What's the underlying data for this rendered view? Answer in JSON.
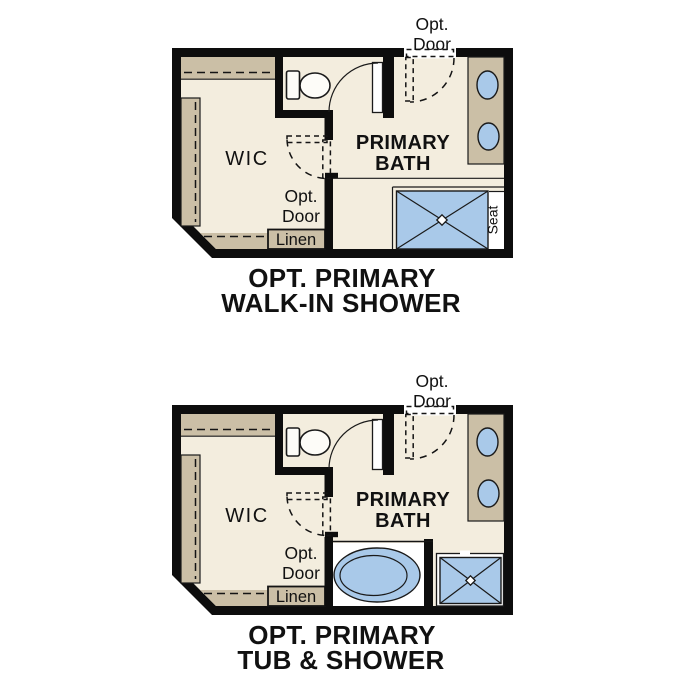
{
  "document": {
    "type": "floor-plan-options-sheet",
    "background": "#ffffff"
  },
  "colors": {
    "wall": "#0d0d0d",
    "floor": "#f3edde",
    "casework_tan": "#cbbfa6",
    "fixture_blue": "#a9c9e9",
    "line": "#1a1a1a",
    "text": "#111111",
    "fixture_white": "#ffffff"
  },
  "plans": [
    {
      "id": "opt-primary-walk-in-shower",
      "title": {
        "line1": "OPT. PRIMARY",
        "line2": "WALK-IN SHOWER"
      },
      "labels": {
        "wic": "WIC",
        "bath_line1": "PRIMARY",
        "bath_line2": "BATH",
        "linen": "Linen",
        "seat": "Seat",
        "opt_door_top_line1": "Opt.",
        "opt_door_top_line2": "Door",
        "opt_door_wic_line1": "Opt.",
        "opt_door_wic_line2": "Door"
      },
      "fixtures": [
        "toilet",
        "toilet-door",
        "double-sink-vanity",
        "walk-in-shower-with-seat",
        "linen-closet",
        "wic-shelving",
        "optional-entry-door",
        "optional-wic-door"
      ]
    },
    {
      "id": "opt-primary-tub-and-shower",
      "title": {
        "line1": "OPT. PRIMARY",
        "line2": "TUB & SHOWER"
      },
      "labels": {
        "wic": "WIC",
        "bath_line1": "PRIMARY",
        "bath_line2": "BATH",
        "linen": "Linen",
        "opt_door_top_line1": "Opt.",
        "opt_door_top_line2": "Door",
        "opt_door_wic_line1": "Opt.",
        "opt_door_wic_line2": "Door"
      },
      "fixtures": [
        "toilet",
        "toilet-door",
        "double-sink-vanity",
        "soaking-tub",
        "corner-shower",
        "linen-closet",
        "wic-shelving",
        "optional-entry-door",
        "optional-wic-door"
      ]
    }
  ]
}
